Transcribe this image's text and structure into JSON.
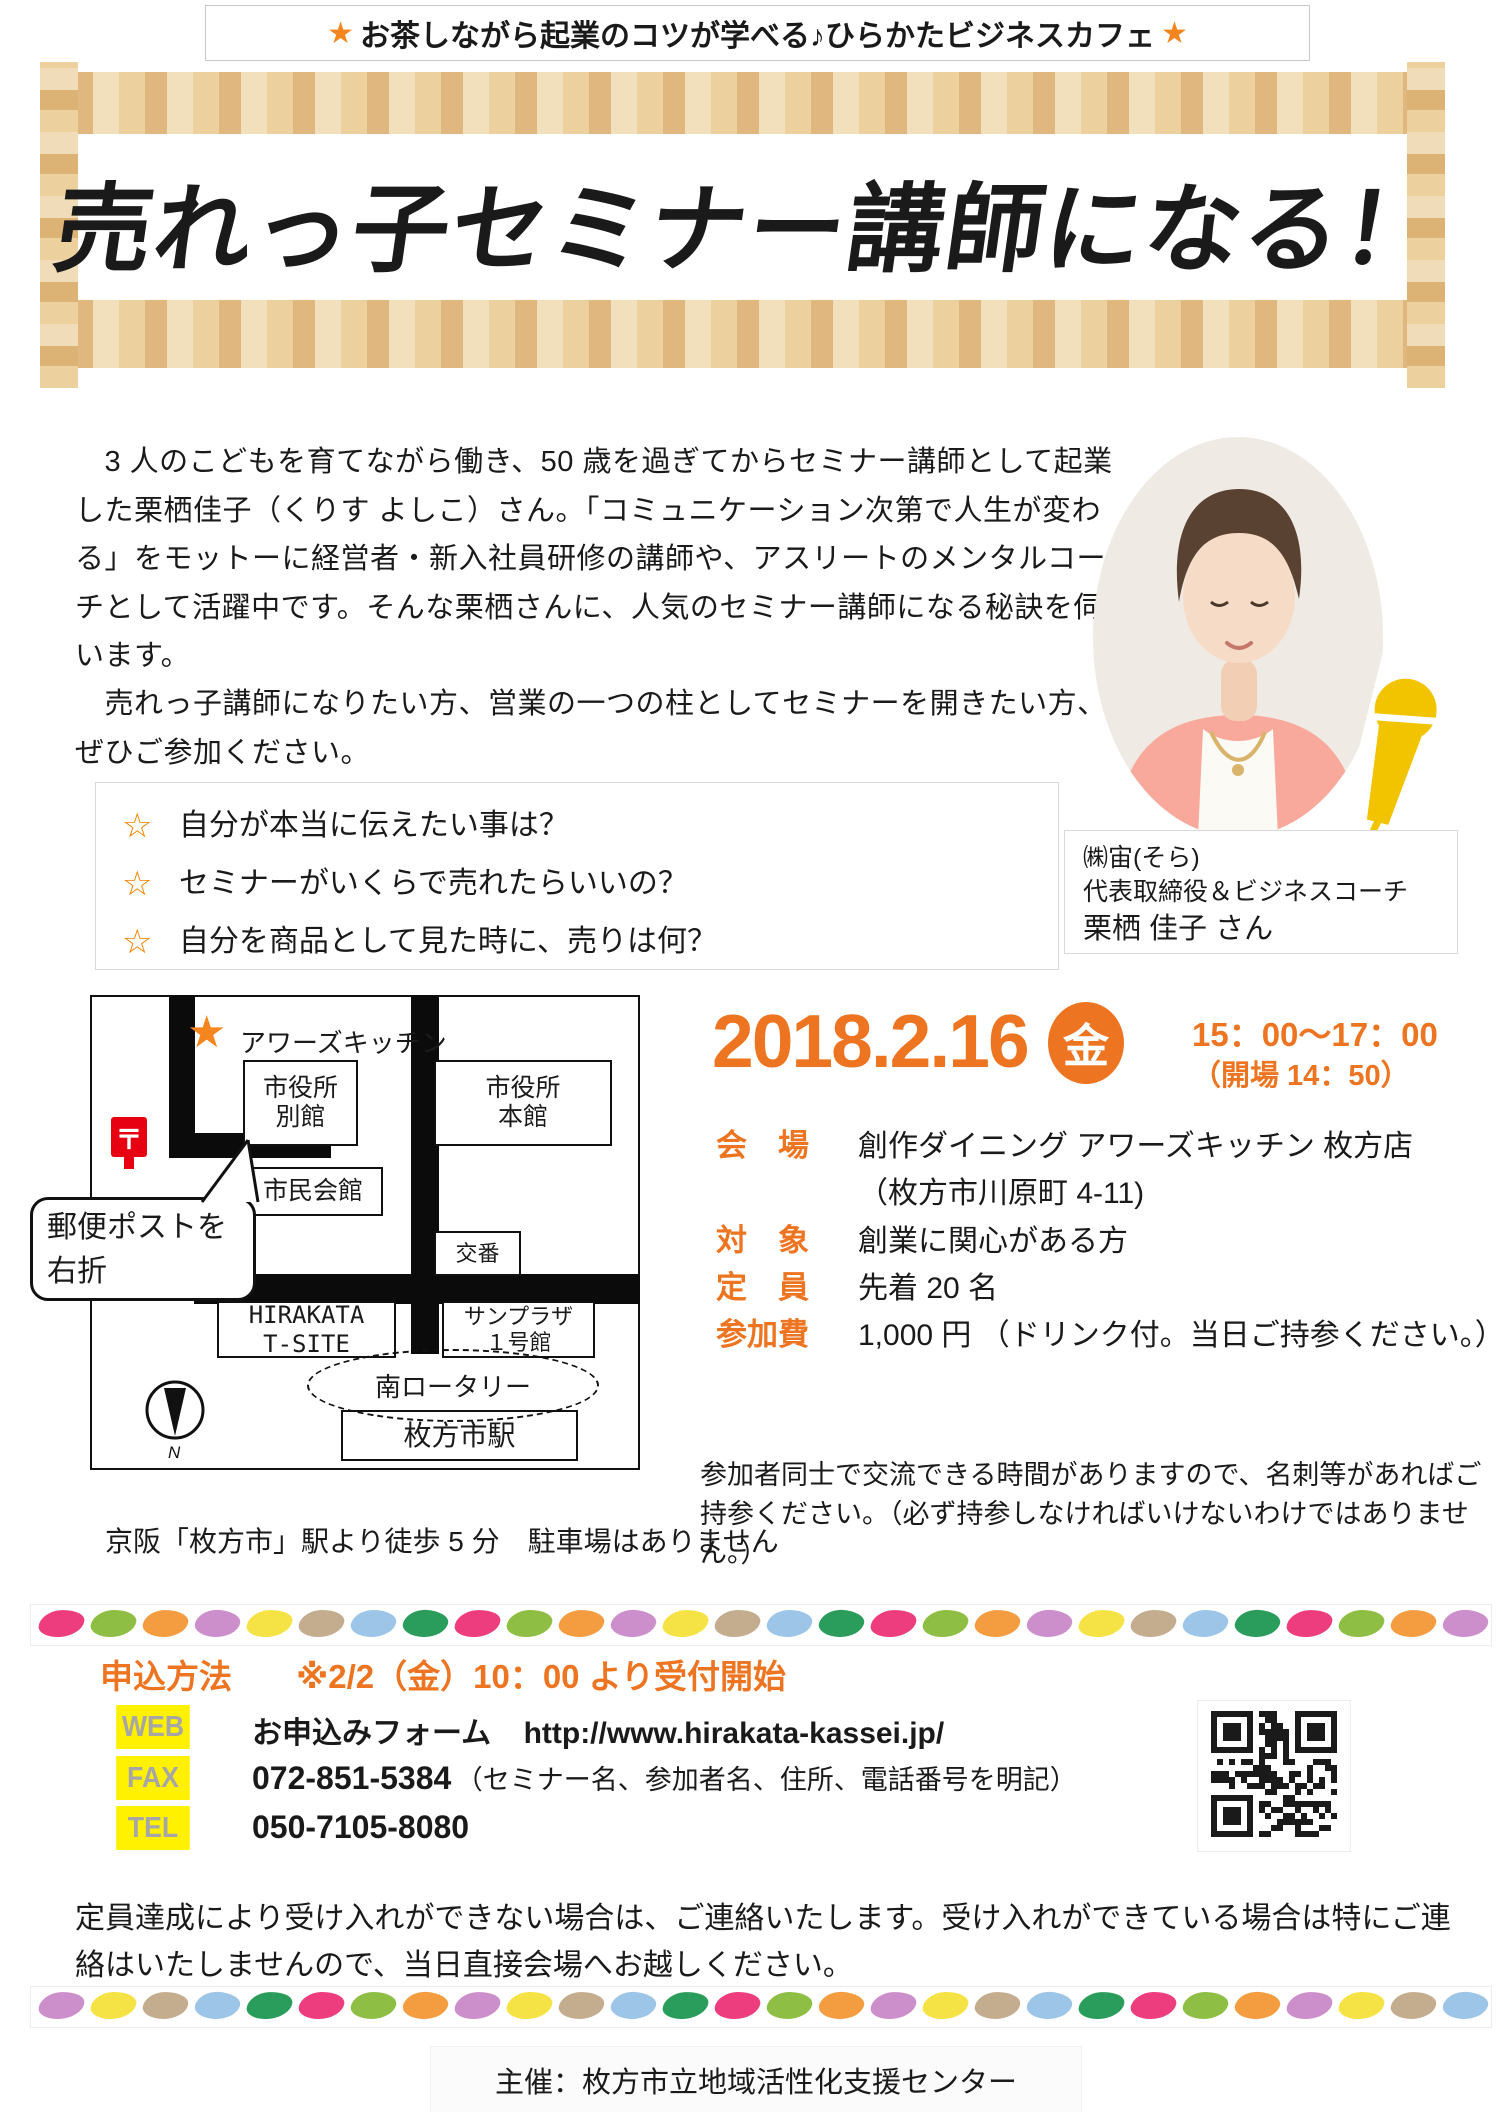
{
  "banner": {
    "star_left": "★",
    "text": "お茶しながら起業のコツが学べる♪ひらかたビジネスカフェ",
    "star_right": "★"
  },
  "title": "売れっ子セミナー講師になる！",
  "intro": {
    "p1": "　3 人のこどもを育てながら働き、50 歳を過ぎてからセミナー講師として起業した栗栖佳子（くりす よしこ）さん。「コミュニケーション次第で人生が変わる」をモットーに経営者・新入社員研修の講師や、アスリートのメンタルコーチとして活躍中です。そんな栗栖さんに、人気のセミナー講師になる秘訣を伺います。",
    "p2": "　売れっ子講師になりたい方、営業の一つの柱としてセミナーを開きたい方、ぜひご参加ください。"
  },
  "speaker": {
    "company": "㈱宙(そら)",
    "role": "代表取締役＆ビジネスコーチ",
    "name": "栗栖 佳子 さん"
  },
  "checklist": {
    "star": "☆",
    "items": [
      "自分が本当に伝えたい事は？",
      "セミナーがいくらで売れたらいいの？",
      "自分を商品として見た時に、売りは何？"
    ]
  },
  "map": {
    "star": "★",
    "star_label": "アワーズキッチン",
    "postal_symbol": "〒",
    "bubble": "郵便ポストを\n右折",
    "compass": "N",
    "buildings": {
      "annex": "市役所\n別館",
      "main_hall": "市役所\n本館",
      "civic_hall": "市民会館",
      "police_box": "交番",
      "t_site": "HIRAKATA\nT-SITE",
      "sunplaza": "サンプラザ\n１号館",
      "rotary": "南ロータリー",
      "station": "枚方市駅"
    },
    "caption": "京阪「枚方市」駅より徒歩 5 分　駐車場はありません"
  },
  "schedule": {
    "date": "2018.2.16",
    "weekday": "金",
    "time": "15：00～17：00",
    "open": "（開場 14：50）"
  },
  "details": {
    "rows": [
      {
        "label": "会　場",
        "value": "創作ダイニング アワーズキッチン 枚方店"
      },
      {
        "label": "",
        "value": "（枚方市川原町 4-11)"
      },
      {
        "label": "対　象",
        "value": "創業に関心がある方"
      },
      {
        "label": "定　員",
        "value": "先着 20 名"
      },
      {
        "label": "参加費",
        "value": "1,000 円 （ドリンク付。当日ご持参ください。）"
      }
    ],
    "note": "参加者同士で交流できる時間がありますので、名刺等があればご持参ください。（必ず持参しなければいけないわけではありません。）"
  },
  "application": {
    "heading": "申込方法",
    "start": "※2/2（金）10：00 より受付開始",
    "web": {
      "label": "WEB",
      "text": "お申込みフォーム",
      "url": "http://www.hirakata-kassei.jp/"
    },
    "fax": {
      "label": "FAX",
      "number": "072-851-5384",
      "note": "（セミナー名、参加者名、住所、電話番号を明記）"
    },
    "tel": {
      "label": "TEL",
      "number": "050-7105-8080"
    },
    "note": "定員達成により受け入れができない場合は、ご連絡いたします。受け入れができている場合は特にご連絡はいたしませんので、当日直接会場へお越しください。"
  },
  "footer": {
    "organizer": "主催：枚方市立地域活性化支援センター"
  },
  "divider": {
    "count": 28,
    "colors": [
      "#EE3D7F",
      "#8FBE45",
      "#F49C40",
      "#CD8FCB",
      "#F5E345",
      "#C4AC8E",
      "#9CC5E8",
      "#2A9D5C"
    ]
  },
  "colors": {
    "accent_orange": "#ED7420",
    "star_orange": "#F5861F",
    "label_yellow": "#FFF100",
    "label_gray": "#A6A6A6",
    "postal_red": "#E60012",
    "mic_yellow": "#F2C400",
    "tape_tan": "#E3BC81"
  }
}
